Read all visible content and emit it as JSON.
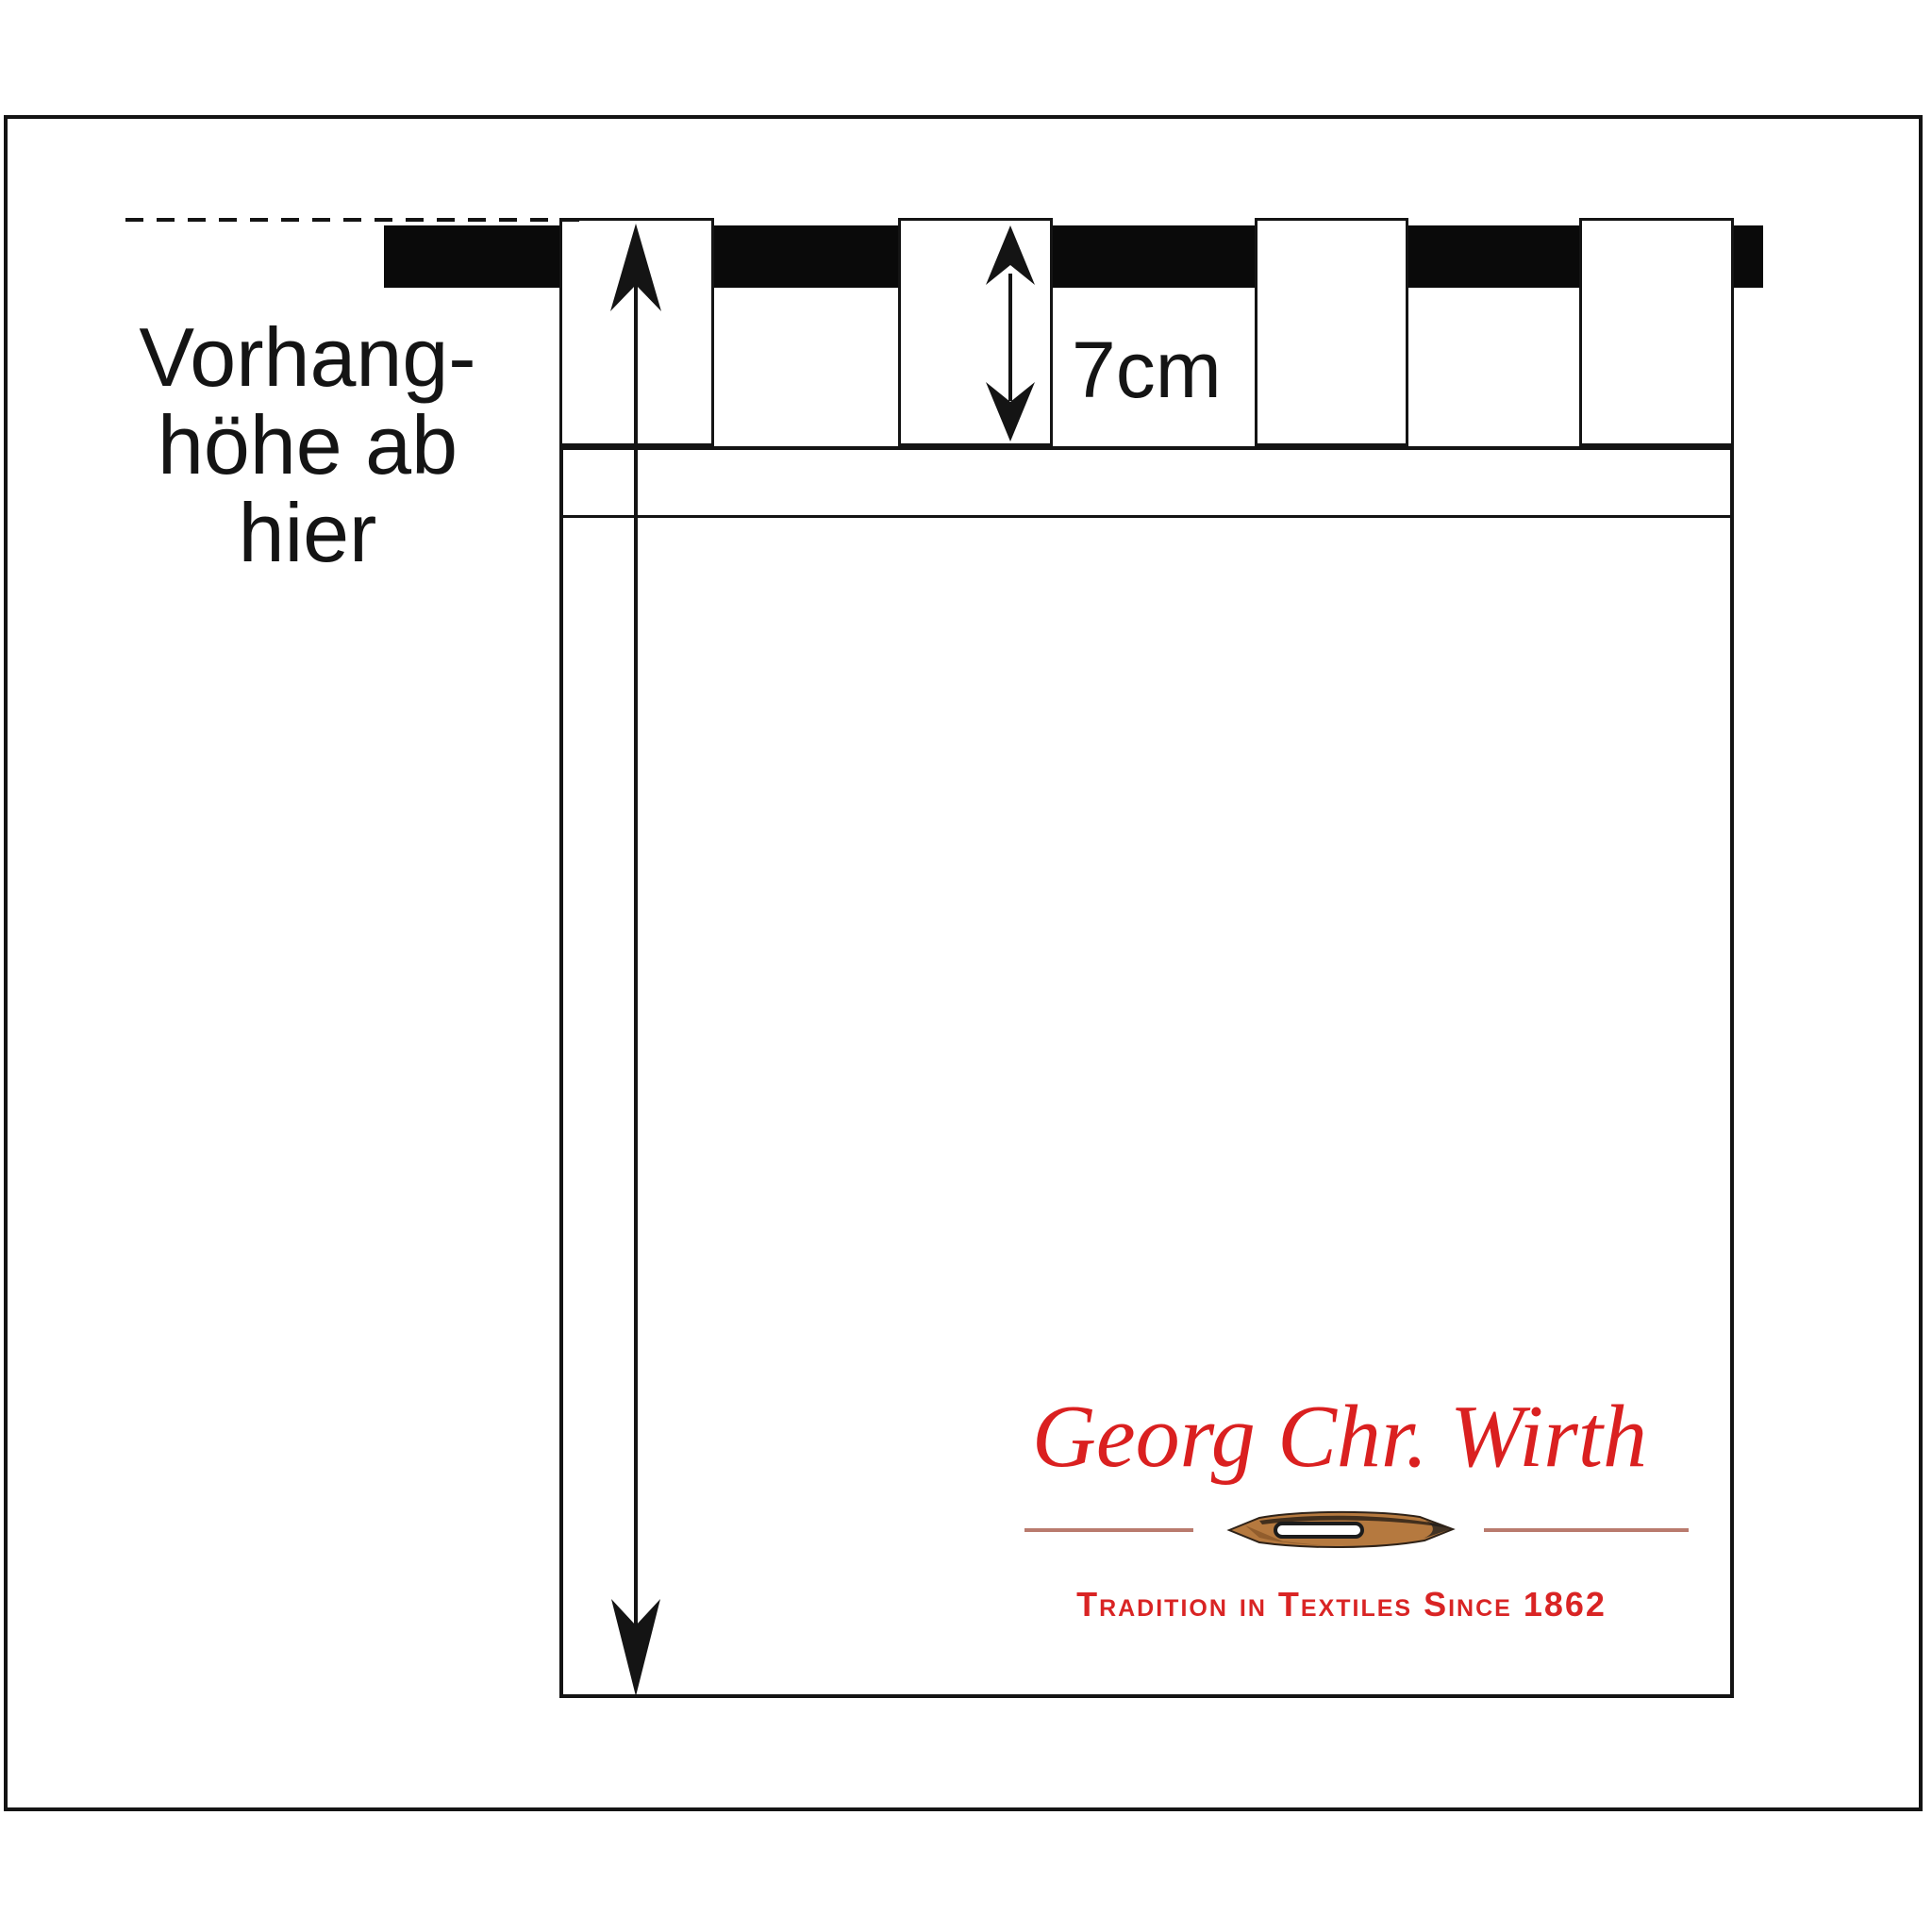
{
  "diagram": {
    "type": "curtain tab-top hanging diagram",
    "reference_note": {
      "lines": [
        "Vorhang-",
        "höhe ab",
        "hier"
      ],
      "full_text": "Vorhanghöhe ab hier"
    },
    "measurements": {
      "tab_height": "7cm"
    },
    "rod": {
      "tab_count": 4,
      "color": "#0a0a0a"
    },
    "colors": {
      "ink": "#141414",
      "background": "#ffffff",
      "brand_red": "#da2020",
      "tagline_red": "#d92424",
      "divider_rose": "#b97b6e",
      "needle_tan": "#b5793f",
      "needle_dark": "#2e2218"
    }
  },
  "logo": {
    "brand": "Georg Chr. Wirth",
    "tagline": "Tradition in Textiles Since 1862"
  }
}
